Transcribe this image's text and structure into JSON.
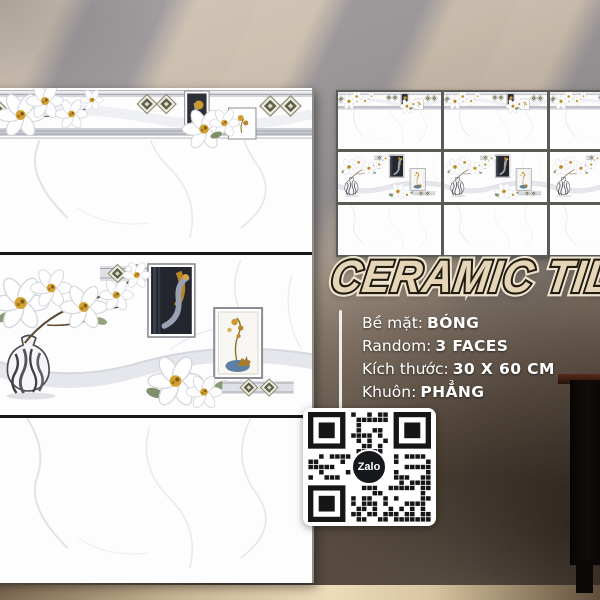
{
  "product": {
    "title": "CERAMIC TILE",
    "specs": [
      {
        "label": "Bề mặt:",
        "value": "BÓNG"
      },
      {
        "label": "Random:",
        "value": "3 FACES"
      },
      {
        "label": "Kích thước:",
        "value": "30 X 60 CM"
      },
      {
        "label": "Khuôn:",
        "value": "PHẲNG"
      }
    ]
  },
  "qr": {
    "logo_label": "Zalo"
  },
  "colors": {
    "title_fill": "#e4d6b6",
    "title_outline_dark": "#241b10",
    "title_outline_light": "#ece4cf",
    "spec_text": "#ffffff",
    "qr_module": "#161616",
    "zalo_badge": "#15181c",
    "wall_light": "#cfc3b5",
    "wall_dark": "#483b30"
  }
}
